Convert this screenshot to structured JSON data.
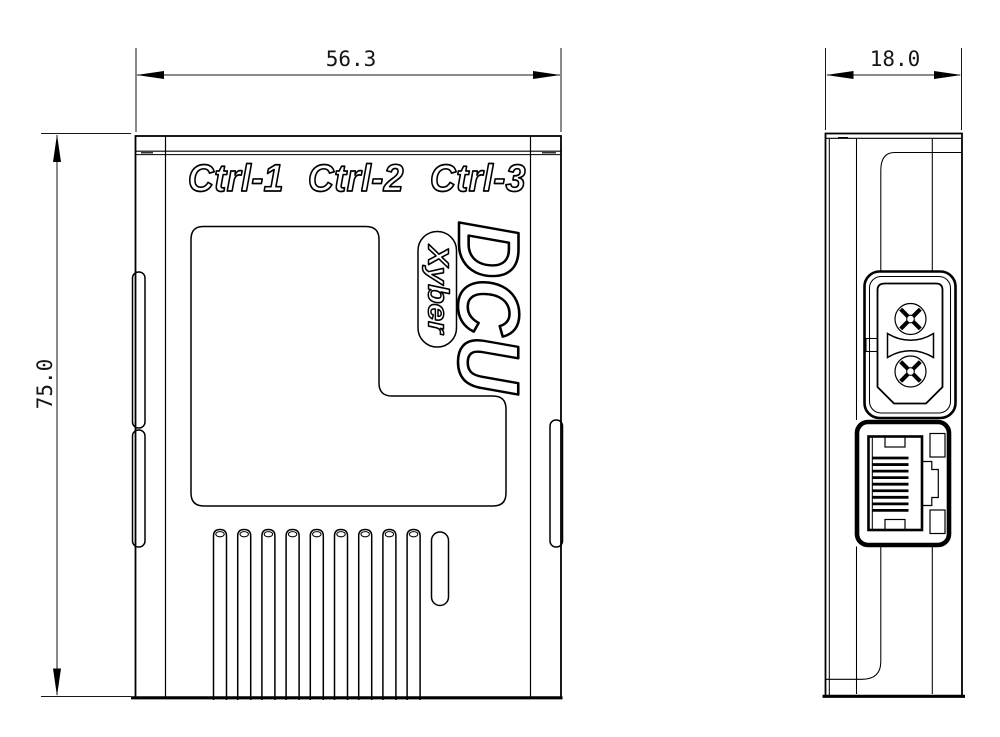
{
  "drawing": {
    "background": "#ffffff",
    "line_color": "#000000",
    "front_view": {
      "width_dim": "56.3",
      "height_dim": "75.0",
      "port_labels": [
        "Ctrl-1",
        "Ctrl-2",
        "Ctrl-3"
      ],
      "product_name": "DCU",
      "brand": "Xyber",
      "vent_slot_count": 9
    },
    "side_view": {
      "depth_dim": "18.0",
      "rj45_pin_count": 9
    }
  }
}
